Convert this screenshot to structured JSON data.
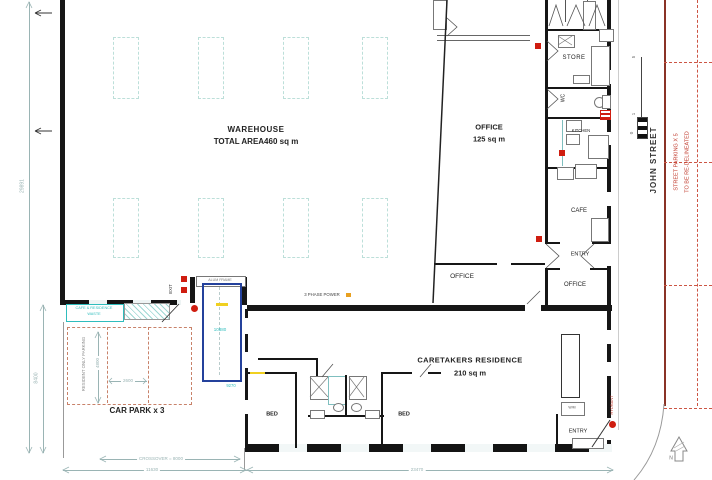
{
  "rooms": {
    "warehouse": {
      "name": "WAREHOUSE",
      "area": "TOTAL AREA460 sq m"
    },
    "office": {
      "name": "OFFICE",
      "area": "125 sq m"
    },
    "caretakers": {
      "name": "CARETAKERS RESIDENCE",
      "area": "210 sq m"
    },
    "store": "STORE",
    "wc": "WC",
    "kitchen": "KITCHEN",
    "cafe": "CAFE",
    "entry_wing": "ENTRY",
    "office_wing": "OFFICE",
    "office_inner": "OFFICE",
    "bed1": "BED",
    "bed2": "BED",
    "entry_residence": "ENTRY"
  },
  "site": {
    "car_park": "CAR PARK x 3",
    "resident_parking": "RESIDENT ONLY PARKING",
    "waste_line1": "CAFE & RESIDENCE",
    "waste_line2": "WASTE",
    "exit": "EXIT",
    "hydrant": "HYDRANT",
    "roller_door": "ALUM FRAME",
    "power": "3 PHASE POWER",
    "laundry": "W/M",
    "north": "N"
  },
  "street": {
    "name": "JOHN STREET",
    "parking_note_line1": "STREET PARKING X 5",
    "parking_note_line2": "TO BE RE-DELINEATED"
  },
  "dims": {
    "site_depth": "29891",
    "residence_depth": "8400",
    "crossover": "CROSSOVER = 8000",
    "frontage_left": "11630",
    "frontage_right": "23470",
    "bay_width": "2600",
    "bay_depth": "4800",
    "drive_length": "10880",
    "drive_width": "9270"
  },
  "scalebar": {
    "top": "5",
    "mid": "1",
    "bottom": "0"
  },
  "colors": {
    "wall": "#161616",
    "dimension": "#9ab4b4",
    "cyan_accent": "#2fbdbd",
    "fire_red": "#cf1d10",
    "note_red": "#c0392b",
    "parking_dash": "#c8826a",
    "vehicle_blue": "#24419c",
    "highlight_yellow": "#f0d020"
  }
}
